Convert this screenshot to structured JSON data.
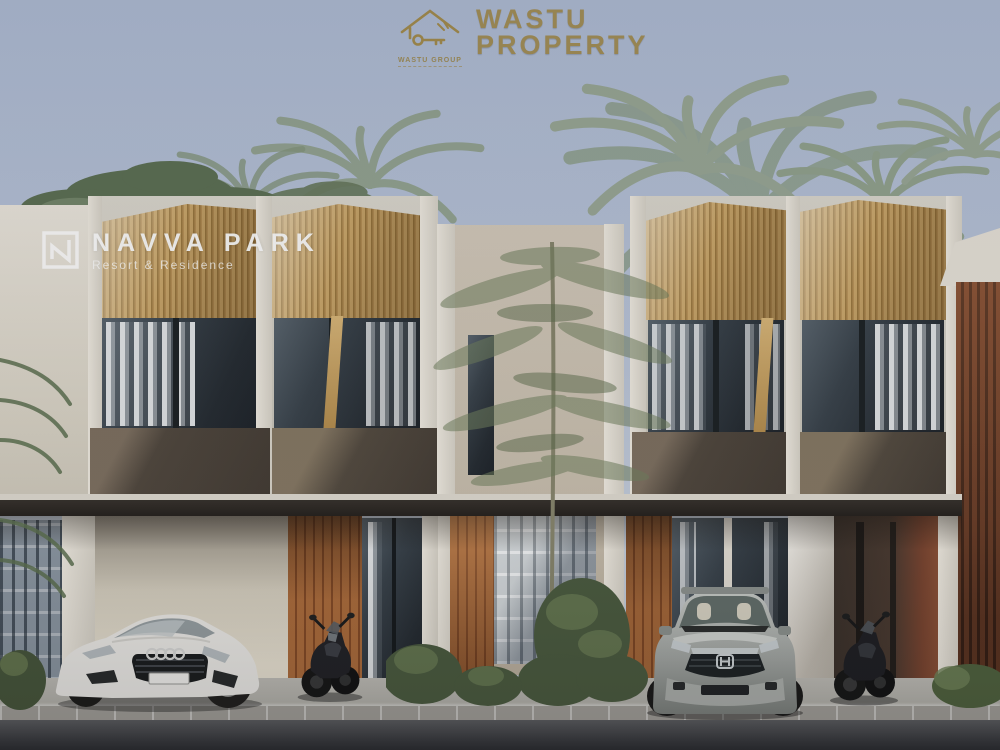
{
  "branding": {
    "line1": "WASTU",
    "line2": "PROPERTY",
    "caption": "WASTU GROUP",
    "gold": "#a58d4e"
  },
  "watermark": {
    "title": "NAVVA PARK",
    "tagline": "Resort & Residence",
    "color": "#ffffff"
  },
  "palette": {
    "sky": "#b6c2d7",
    "timber_slats": "#c8a163",
    "concrete": "#d7d3c9",
    "awning_dark": "#4b433a",
    "orange_wood": "#b5723f",
    "dark_red_wood": "#6f3d2a",
    "window_glass": "#30383c",
    "foliage": "#8fa08f",
    "pavement": "#b6b4ae",
    "road": "#46474b",
    "car_white": "#edebe7",
    "car_silver": "#b3b6b2"
  },
  "scene": {
    "objects": [
      {
        "name": "townhouse-left-unit"
      },
      {
        "name": "townhouse-right-unit"
      },
      {
        "name": "white-coupe-car"
      },
      {
        "name": "silver-suv-car"
      },
      {
        "name": "motorcycle-left"
      },
      {
        "name": "motorcycle-right"
      },
      {
        "name": "ornamental-tree"
      },
      {
        "name": "palm-trees"
      },
      {
        "name": "breeze-block-walls"
      },
      {
        "name": "driveway"
      },
      {
        "name": "road"
      }
    ]
  }
}
